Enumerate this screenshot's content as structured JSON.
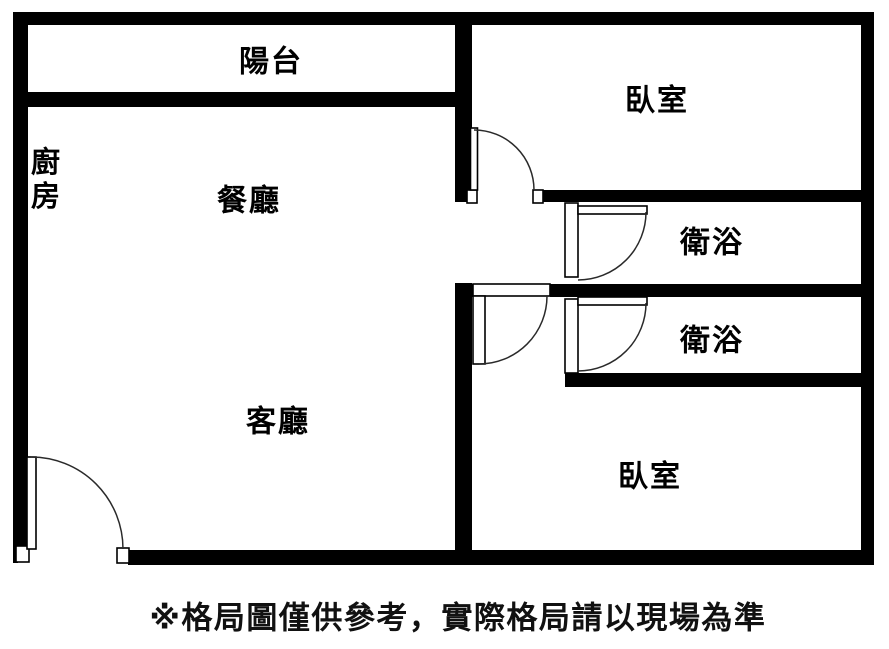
{
  "page": {
    "background_color": "#ffffff",
    "wall_color": "#000000",
    "arc_color": "#2a2a2a",
    "text_color": "#000000"
  },
  "floorplan": {
    "rooms": [
      {
        "id": "balcony",
        "label": "陽台"
      },
      {
        "id": "bedroom-top",
        "label": "臥室"
      },
      {
        "id": "kitchen",
        "label": "廚房"
      },
      {
        "id": "dining",
        "label": "餐廳"
      },
      {
        "id": "bath-upper",
        "label": "衛浴"
      },
      {
        "id": "bath-lower",
        "label": "衛浴"
      },
      {
        "id": "living",
        "label": "客廳"
      },
      {
        "id": "bedroom-bottom",
        "label": "臥室"
      }
    ],
    "icons": [
      {
        "id": "door-arc-bedroom-top"
      },
      {
        "id": "door-arc-hallway"
      },
      {
        "id": "door-arc-bath-upper"
      },
      {
        "id": "door-arc-bath-lower"
      },
      {
        "id": "door-arc-entrance"
      }
    ],
    "disclaimer": "※格局圖僅供參考，實際格局請以現場為準"
  }
}
